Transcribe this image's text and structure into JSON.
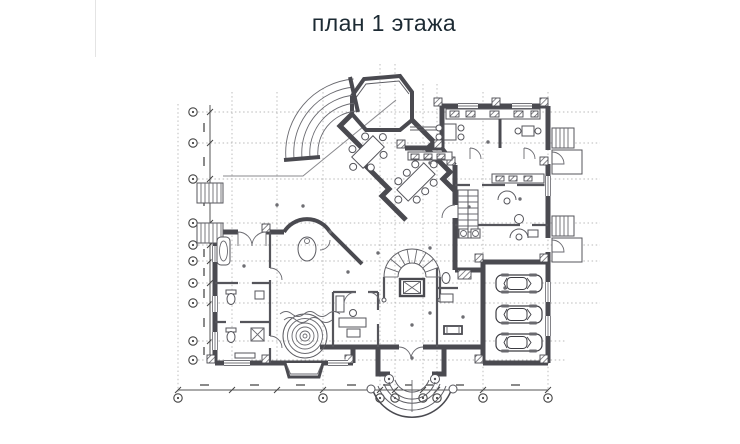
{
  "page": {
    "background_color": "#ffffff"
  },
  "title": {
    "text": "план 1 этажа",
    "color": "#1c2a33"
  },
  "plan": {
    "kind": "architectural floor plan of the 1st floor of a mansion",
    "colors": {
      "wall": "#4a4a50",
      "thin_wall": "#55555b",
      "grid_line": "#a3a3a3",
      "axis": "#444444",
      "paper": "#ffffff"
    },
    "axis_markers": {
      "left_count": 10,
      "bottom_count": 8
    },
    "garage": {
      "car_count": 3
    },
    "features": [
      "octagonal-bay-window",
      "fan-shaped-conservatory",
      "diagonal-dining-hall",
      "dining-tables-with-chairs",
      "grand-horseshoe-staircase",
      "elevator-shaft",
      "round-pool-jacuzzi",
      "spa-bathrooms",
      "study-room",
      "round-turret-room",
      "entrance-portico-with-columns",
      "curved-entrance-steps",
      "garage-with-three-cars",
      "external-stairs",
      "terrace-outline",
      "kitchen-counters",
      "dimension-lines"
    ]
  }
}
